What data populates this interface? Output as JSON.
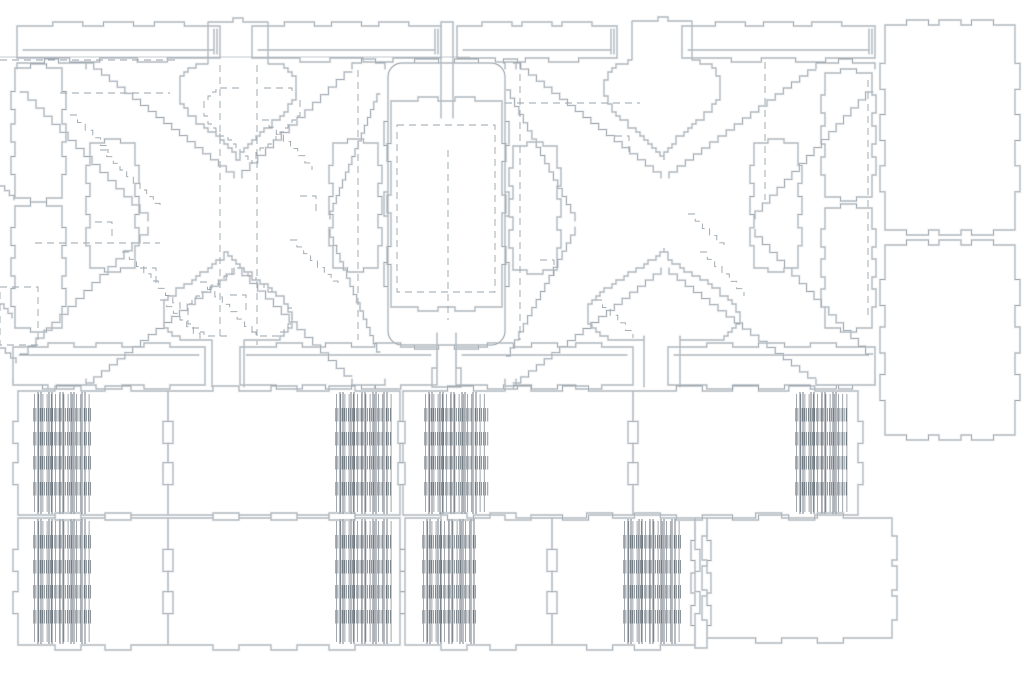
{
  "meta": {
    "title": "Laser-cut parts nesting layout drawing"
  },
  "canvas": {
    "width": 1024,
    "height": 675,
    "background": "#ffffff"
  },
  "style": {
    "line_color": "#a6aeb6",
    "glow_color": "#eceef0",
    "dash_color": "#99a3ab",
    "hatch_color": "#5f6a73",
    "cluster_line_color": "#8a929a",
    "slot_color": "#747e87",
    "hairline_color": "#c6ccd1",
    "line_width": 0.9,
    "glow_width": 2.8,
    "dash_pattern": "7 5"
  },
  "hairline": {
    "y": 57,
    "x1": 0,
    "x2": 470
  },
  "strip_y": 26,
  "strip_h": 32,
  "strips": [
    {
      "name": "top-strip-1",
      "x": 17,
      "w": 203
    },
    {
      "name": "top-strip-2",
      "x": 252,
      "w": 189
    },
    {
      "name": "top-strip-3",
      "x": 457,
      "w": 160
    },
    {
      "name": "top-strip-4",
      "x": 682,
      "w": 193
    }
  ],
  "rail_y": 347,
  "rail_h": 38,
  "rails": [
    {
      "name": "bottom-rail-1",
      "x": 13,
      "w": 192
    },
    {
      "name": "bottom-rail-2",
      "x": 240,
      "w": 197
    },
    {
      "name": "bottom-rail-3",
      "x": 456,
      "w": 177
    },
    {
      "name": "bottom-rail-4",
      "x": 668,
      "w": 207
    }
  ],
  "xframes": [
    {
      "name": "x-frame-panel-left",
      "edges": [
        [
          86,
          63,
          234,
          178
        ],
        [
          352,
          72,
          242,
          178
        ],
        [
          20,
          92,
          148,
          221
        ],
        [
          20,
          354,
          148,
          227
        ],
        [
          86,
          383,
          234,
          268
        ],
        [
          352,
          376,
          242,
          268
        ],
        [
          380,
          94,
          330,
          219
        ],
        [
          380,
          352,
          330,
          229
        ]
      ],
      "feet": [
        [
          17,
          86,
          63,
          1
        ],
        [
          352,
          385,
          63,
          1
        ],
        [
          13,
          86,
          385,
          -1
        ],
        [
          352,
          385,
          385,
          -1
        ]
      ]
    },
    {
      "name": "x-frame-panel-right",
      "edges": [
        [
          513,
          63,
          661,
          178
        ],
        [
          816,
          70,
          669,
          178
        ],
        [
          506,
          90,
          575,
          221
        ],
        [
          506,
          356,
          575,
          227
        ],
        [
          513,
          383,
          661,
          268
        ],
        [
          816,
          378,
          669,
          268
        ],
        [
          873,
          92,
          755,
          219
        ],
        [
          873,
          354,
          755,
          229
        ]
      ],
      "feet": [
        [
          505,
          516,
          63,
          1
        ],
        [
          816,
          875,
          63,
          1
        ],
        [
          505,
          516,
          385,
          -1
        ],
        [
          816,
          875,
          385,
          -1
        ]
      ]
    }
  ],
  "hearts": [
    {
      "name": "heart-cutout-left",
      "cx": 238,
      "top": 62,
      "w": 120,
      "h": 98,
      "neck": 56,
      "cap": 22
    },
    {
      "name": "heart-cutout-right",
      "cx": 663,
      "top": 60,
      "w": 116,
      "h": 100,
      "neck": 60,
      "cap": 21
    }
  ],
  "spades": [
    {
      "name": "spade-cutout-left",
      "cx": 227,
      "apex": 250,
      "w": 130,
      "h": 92,
      "stem": 33,
      "bottom": 387
    },
    {
      "name": "spade-cutout-right",
      "cx": 663,
      "apex": 248,
      "w": 152,
      "h": 94,
      "stem": 31,
      "bottom": 387
    }
  ],
  "slender_rects": [
    {
      "name": "slat-upright-a",
      "x": 15,
      "y": 68,
      "w": 47,
      "h": 130
    },
    {
      "name": "slat-upright-b",
      "x": 15,
      "y": 206,
      "w": 47,
      "h": 122
    },
    {
      "name": "slat-upright-c",
      "x": 90,
      "y": 143,
      "w": 45,
      "h": 125
    },
    {
      "name": "slat-upright-d",
      "x": 333,
      "y": 143,
      "w": 45,
      "h": 125
    },
    {
      "name": "slat-upright-e",
      "x": 513,
      "y": 146,
      "w": 44,
      "h": 124
    },
    {
      "name": "slat-upright-f",
      "x": 754,
      "y": 143,
      "w": 44,
      "h": 125
    },
    {
      "name": "slat-upright-g",
      "x": 825,
      "y": 73,
      "w": 47,
      "h": 124
    },
    {
      "name": "slat-upright-h",
      "x": 825,
      "y": 208,
      "w": 47,
      "h": 120
    }
  ],
  "big_panel": {
    "name": "seat-panel",
    "x": 388,
    "y": 63,
    "w": 117,
    "h": 282,
    "r": 14,
    "inner": {
      "x": 391,
      "y": 101,
      "w": 111,
      "h": 206
    },
    "dashed_inner": {
      "x": 397,
      "y": 125,
      "w": 98,
      "h": 167
    },
    "neck_top": {
      "x1": 441,
      "x2": 453,
      "top": 22,
      "bottom": 118
    },
    "neck_bottom": {
      "x1": 437,
      "x2": 456,
      "top": 333,
      "bottom": 387,
      "flare": 5,
      "flare_y": 368
    }
  },
  "right_rects": [
    {
      "name": "side-panel-top",
      "x": 885,
      "y": 25,
      "w": 130,
      "h": 205
    },
    {
      "name": "side-panel-bottom",
      "x": 885,
      "y": 245,
      "w": 130,
      "h": 190
    }
  ],
  "slat_rows": [
    {
      "y": 391,
      "h": 124,
      "bands": [
        17,
        41,
        65,
        91
      ],
      "panels": [
        {
          "name": "hinge-panel-r1-1",
          "x": 18,
          "w": 150,
          "clusters": [
            {
              "x": 33,
              "w": 59
            }
          ]
        },
        {
          "name": "hinge-panel-r1-2",
          "x": 168,
          "w": 232,
          "clusters": [
            {
              "x": 335,
              "w": 57
            }
          ]
        },
        {
          "name": "hinge-panel-r1-3",
          "x": 403,
          "w": 230,
          "clusters": [
            {
              "x": 424,
              "w": 64
            }
          ]
        },
        {
          "name": "hinge-panel-r1-4",
          "x": 633,
          "w": 225,
          "clusters": [
            {
              "x": 795,
              "w": 52
            }
          ]
        }
      ]
    },
    {
      "y": 518,
      "h": 127,
      "bands": [
        17,
        42,
        67,
        92
      ],
      "panels": [
        {
          "name": "hinge-panel-r2-1",
          "x": 18,
          "w": 150,
          "clusters": [
            {
              "x": 33,
              "w": 59
            }
          ]
        },
        {
          "name": "hinge-panel-r2-2",
          "x": 168,
          "w": 232,
          "clusters": [
            {
              "x": 335,
              "w": 57
            }
          ]
        },
        {
          "name": "hinge-panel-r2-3",
          "x": 405,
          "w": 147,
          "clusters": [
            {
              "x": 422,
              "w": 55
            }
          ]
        },
        {
          "name": "hinge-panel-r2-4",
          "x": 552,
          "w": 143,
          "clusters": [
            {
              "x": 623,
              "w": 58
            }
          ]
        }
      ]
    }
  ],
  "thin_vert": {
    "name": "spacer-strip",
    "x": 695,
    "y": 518,
    "w": 12,
    "h": 130
  },
  "big_plain": {
    "name": "plain-panel",
    "x": 707,
    "y": 518,
    "w": 185,
    "h": 120
  },
  "edge_marks": [
    [
      0,
      186,
      14,
      200
    ],
    [
      0,
      304,
      12,
      318
    ],
    [
      0,
      348,
      16,
      363
    ]
  ],
  "dashed": {
    "lines": [
      [
        220,
        65,
        220,
        340
      ],
      [
        257,
        65,
        257,
        345
      ],
      [
        358,
        70,
        358,
        340
      ],
      [
        520,
        62,
        520,
        340
      ],
      [
        448,
        150,
        448,
        320
      ],
      [
        765,
        62,
        765,
        200
      ],
      [
        868,
        80,
        868,
        320
      ],
      [
        0,
        60,
        180,
        60
      ],
      [
        60,
        93,
        170,
        93
      ],
      [
        505,
        103,
        640,
        103
      ],
      [
        35,
        243,
        160,
        243
      ]
    ],
    "diagonals": [
      [
        100,
        150,
        160,
        210
      ],
      [
        122,
        252,
        180,
        310
      ],
      [
        200,
        282,
        252,
        334
      ],
      [
        262,
        120,
        312,
        170
      ],
      [
        70,
        115,
        108,
        153
      ],
      [
        290,
        240,
        338,
        288
      ],
      [
        595,
        300,
        633,
        338
      ],
      [
        700,
        252,
        744,
        296
      ],
      [
        688,
        214,
        724,
        250
      ],
      [
        160,
        300,
        200,
        340
      ]
    ],
    "zigzags": [
      [
        95,
        222,
        112,
        238
      ],
      [
        230,
        295,
        246,
        311
      ],
      [
        140,
        268,
        156,
        284
      ],
      [
        300,
        196,
        316,
        212
      ],
      [
        615,
        136,
        629,
        152
      ],
      [
        540,
        260,
        554,
        276
      ]
    ],
    "rects": [
      [
        0,
        287,
        38,
        58
      ],
      [
        397,
        125,
        98,
        167
      ]
    ],
    "heart": {
      "cx": 252,
      "top": 86,
      "w": 96,
      "h": 78,
      "neck": 26
    },
    "spade": {
      "cx": 240,
      "apex": 262,
      "w": 104,
      "h": 74,
      "stem": 26,
      "bottom": 340
    }
  }
}
